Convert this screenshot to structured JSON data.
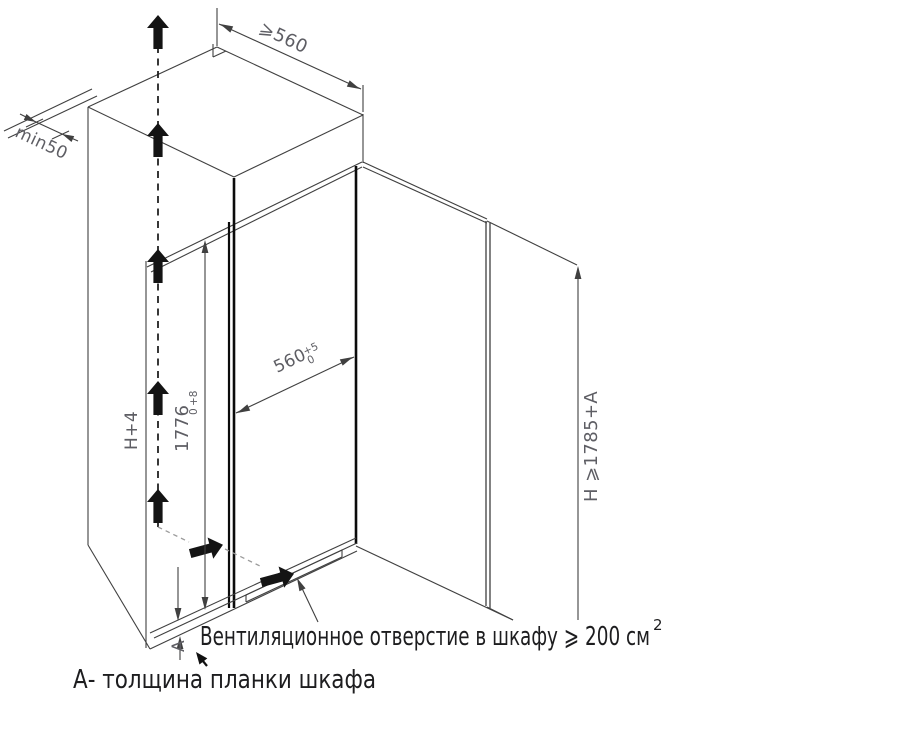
{
  "colors": {
    "line": "#404040",
    "thick_line": "#0b0b0b",
    "dimension_text": "#5e5e64",
    "note_text": "#1d1d1f",
    "airflow_dash_gray": "#9b9b9b",
    "background": "#ffffff"
  },
  "dimensions": {
    "top_depth": "⩾560",
    "wall_gap": "min50",
    "niche_height": "H+4",
    "inner_height_value": "1776",
    "inner_height_tol_plus": "+8",
    "inner_height_tol_minus": "0",
    "inner_width_value": "560",
    "inner_width_tol_plus": "+5",
    "inner_width_tol_minus": "0",
    "total_height": "H ⩾1785+А",
    "plank_thickness_label": "А"
  },
  "notes": {
    "ventilation": "Вентиляционное отверстие в шкафу ⩾ 200 см",
    "ventilation_sup": "2",
    "plank": "А- толщина планки шкафа"
  }
}
